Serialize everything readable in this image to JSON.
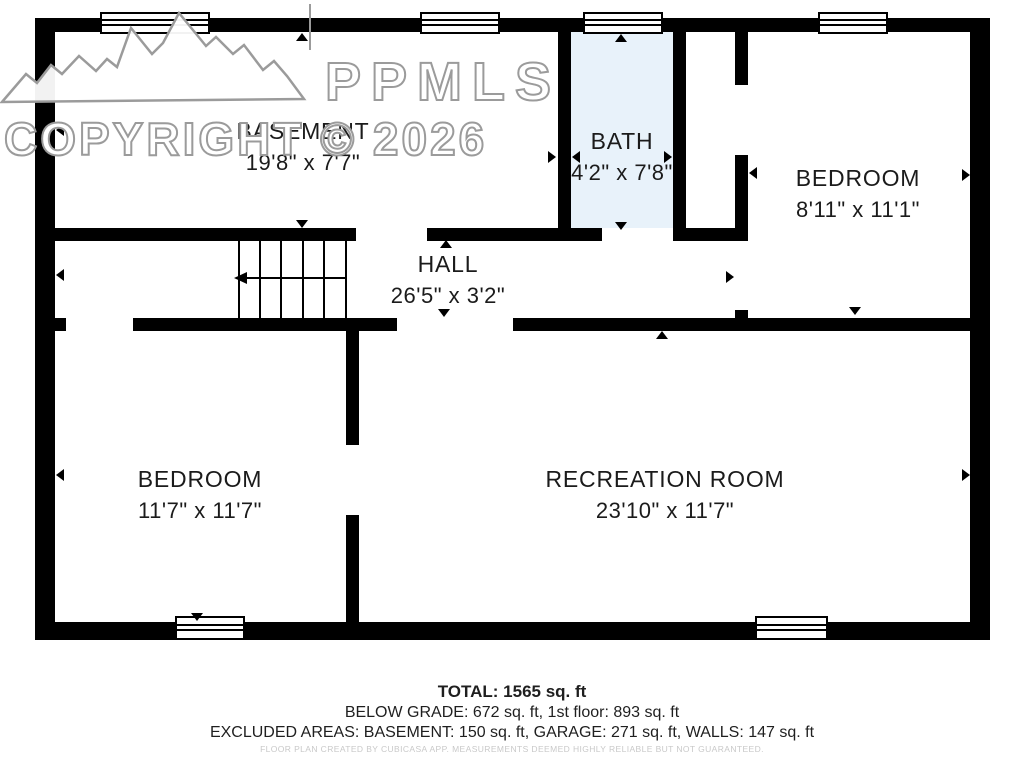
{
  "watermark": {
    "logo_text": "PPMLS",
    "copyright_text": "COPYRIGHT © 2026",
    "logo_icon": "mountain-range-icon"
  },
  "rooms": {
    "basement": {
      "name": "BASEMENT",
      "dimensions": "19'8\" x 7'7\""
    },
    "bath": {
      "name": "BATH",
      "dimensions": "4'2\" x 7'8\""
    },
    "bedroom_right": {
      "name": "BEDROOM",
      "dimensions": "8'11\" x 11'1\""
    },
    "hall": {
      "name": "HALL",
      "dimensions": "26'5\" x 3'2\""
    },
    "bedroom_left": {
      "name": "BEDROOM",
      "dimensions": "11'7\" x 11'7\""
    },
    "recreation_room": {
      "name": "RECREATION ROOM",
      "dimensions": "23'10\" x 11'7\""
    }
  },
  "summary": {
    "total": "TOTAL: 1565 sq. ft",
    "below_grade": "BELOW GRADE: 672 sq. ft, 1st floor: 893 sq. ft",
    "excluded": "EXCLUDED AREAS: BASEMENT: 150 sq. ft, GARAGE: 271 sq. ft, WALLS: 147 sq. ft",
    "disclaimer": "FLOOR PLAN CREATED BY CUBICASA APP. MEASUREMENTS DEEMED HIGHLY RELIABLE BUT NOT GUARANTEED."
  },
  "colors": {
    "wall": "#000000",
    "bath_fill": "#e8f2fa",
    "label_text": "#1b1b1b",
    "watermark_stroke": "#9b9b9b",
    "disclaimer_text": "#c9c9c9"
  }
}
